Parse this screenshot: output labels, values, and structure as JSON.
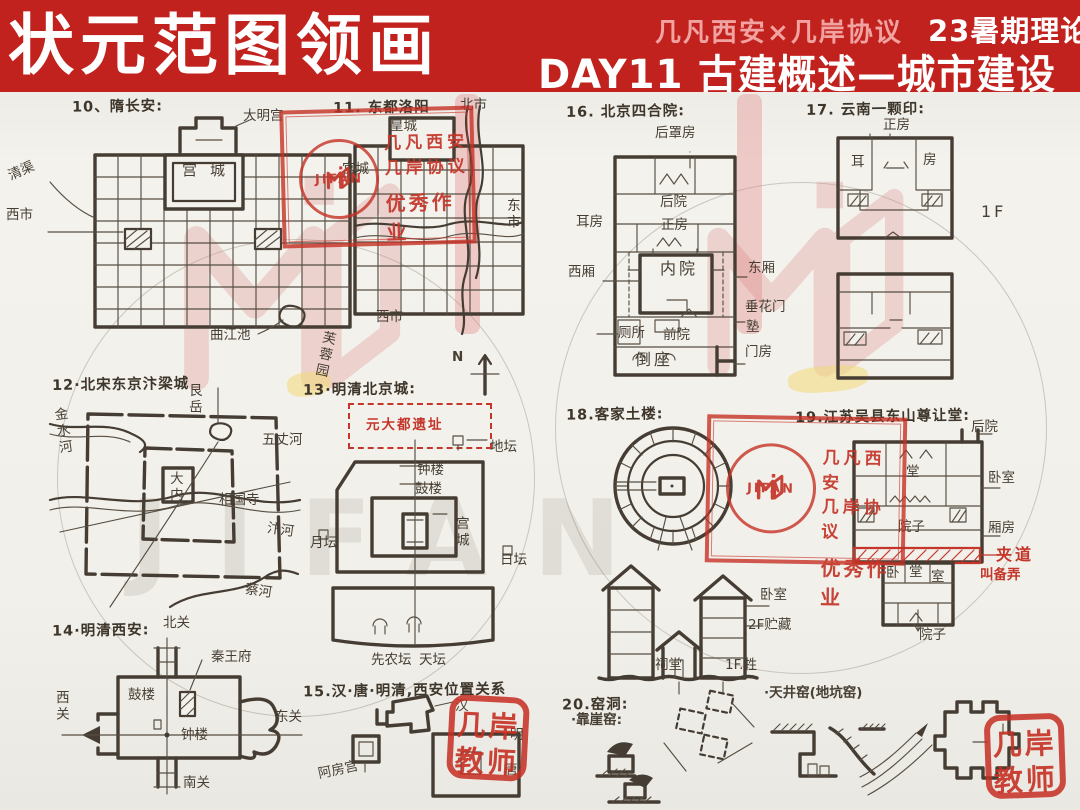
{
  "header": {
    "main_title": "状元范图领画",
    "collab": "几凡西安×几岸协议",
    "term": "23暑期理论",
    "day_title": "DAY11 古建概述—城市建设"
  },
  "watermark": {
    "brand": "JIFAN"
  },
  "stamps": {
    "excellent": {
      "logo": "JIFAN",
      "line1": "几凡西安",
      "line2": "几岸协议",
      "line3": "优秀作业"
    },
    "teacher": {
      "line1": "几岸",
      "line2": "教师"
    }
  },
  "sketches": {
    "s10": {
      "title": "10、隋长安:",
      "labels": {
        "damingong": "大明宫",
        "gongcheng": "宫城",
        "qingqu": "清渠",
        "xishi": "西市",
        "qujiangchi": "曲江池",
        "furongyuan": "芙蓉园"
      }
    },
    "s11": {
      "title": "11. 东都洛阳",
      "labels": {
        "beishi": "北市",
        "huangcheng": "皇城",
        "gongcheng": "宫城",
        "dongshi": "东市",
        "xishi": "西市"
      }
    },
    "s12": {
      "title": "12·北宋东京汴梁城",
      "labels": {
        "genyue": "艮岳",
        "jinshuihe": "金水河",
        "wuzhanghe": "五丈河",
        "danei": "大内",
        "xiangguosi": "相国寺",
        "bianhe": "汴河",
        "caihe": "蔡河"
      }
    },
    "s13": {
      "title": "13·明清北京城:",
      "labels": {
        "yuandadu": "元大都遗址",
        "ditan": "地坛",
        "zhonglou": "钟楼",
        "gulou": "鼓楼",
        "gongcheng": "宫城",
        "yuetan": "月坛",
        "ritan": "日坛",
        "xiannongtan": "先农坛",
        "tiantan": "天坛",
        "north": "N"
      }
    },
    "s14": {
      "title": "14·明清西安:",
      "labels": {
        "beiguan": "北关",
        "qinwangfu": "秦王府",
        "xiguan": "西关",
        "dongguan": "东关",
        "gulou": "鼓楼",
        "zhonglou": "钟楼",
        "nanguan": "南关"
      }
    },
    "s15": {
      "title": "15.汉·唐·明清,西安位置关系",
      "labels": {
        "han": "汉",
        "epanggong": "阿房宫",
        "ming": "明",
        "tang": "唐"
      }
    },
    "s16": {
      "title": "16. 北京四合院:",
      "labels": {
        "houzhaofang": "后罩房",
        "houyuan": "后院",
        "erfang": "耳房",
        "zhengfang": "正房",
        "xixiang": "西厢",
        "neiyuan": "内院",
        "dongxiang": "东厢",
        "chuihuamen": "垂花门",
        "cesuo": "厕所",
        "qianyuan": "前院",
        "shu": "塾",
        "daozuo": "倒座",
        "menfang": "门房"
      }
    },
    "s17": {
      "title": "17. 云南一颗印:",
      "labels": {
        "zhengfang": "正房",
        "er": "耳",
        "fang": "房",
        "f1": "1F"
      }
    },
    "s18": {
      "title": "18.客家土楼:",
      "labels": {
        "woshi": "卧室",
        "zhucang": "2F贮藏",
        "citang": "祠堂",
        "sheng": "1F.牲"
      }
    },
    "s19": {
      "title": "19.江苏吴县东山尊让堂:",
      "labels": {
        "houyuan": "后院",
        "tang": "堂",
        "woshi": "卧室",
        "yuanzi": "院子",
        "xiangfang": "厢房",
        "jiadao": "夹道",
        "beilong": "叫备弄",
        "wo": "卧",
        "tang2": "堂",
        "shi": "室",
        "yuanzi2": "院子"
      }
    },
    "s20": {
      "title": "20.窑洞:",
      "labels": {
        "kaoyayao": "·靠崖窑:",
        "tianjingyao": "·天井窑(地坑窑)"
      }
    }
  }
}
